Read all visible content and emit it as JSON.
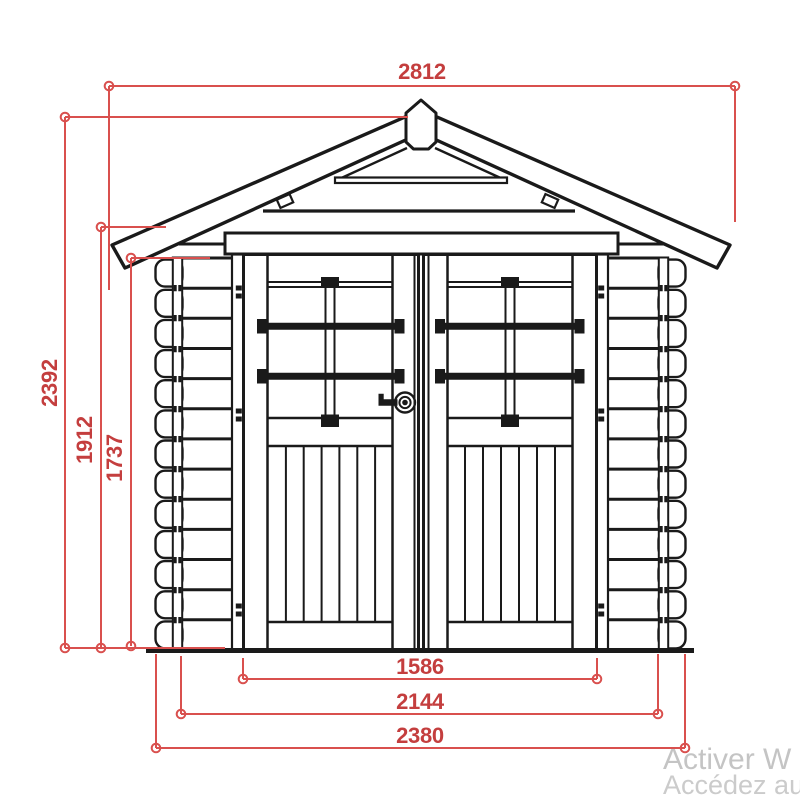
{
  "dims": {
    "roof_width": "2812",
    "overall_height": "2392",
    "eave_height": "1912",
    "wall_height": "1737",
    "door_width": "1586",
    "body_width": "2144",
    "overall_width": "2380"
  },
  "watermark": {
    "line1": "Activer W",
    "line2": "Accédez au"
  },
  "colors": {
    "dimension_line": "#d9504e",
    "dimension_text": "#c43e3e",
    "drawing_line": "#1a1a1a",
    "watermark": "#c4c4c4",
    "background": "#ffffff"
  }
}
